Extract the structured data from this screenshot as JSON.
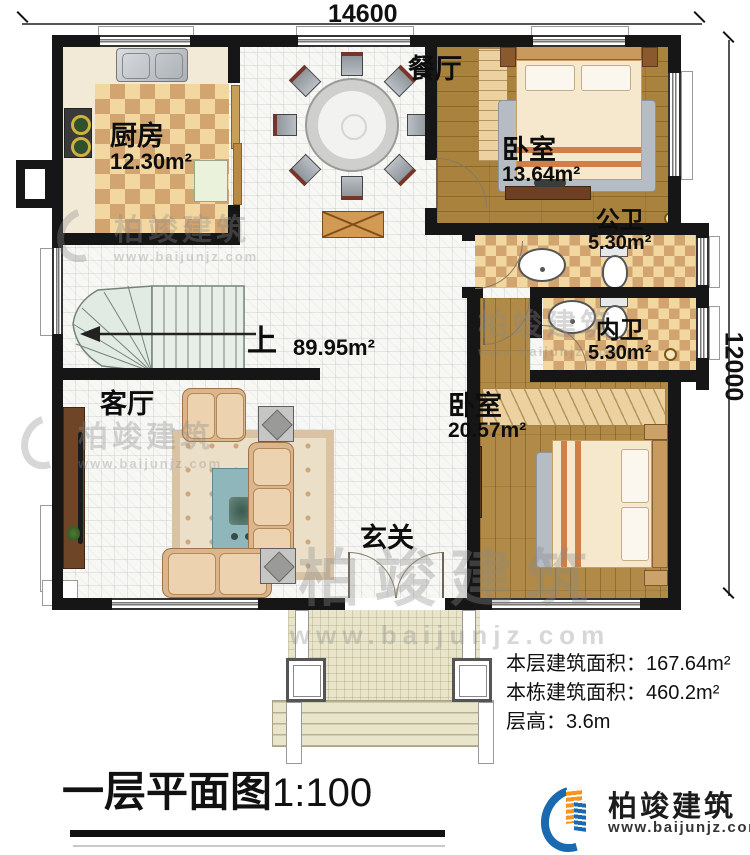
{
  "dimensions": {
    "top": "14600",
    "right": "12000"
  },
  "rooms": {
    "kitchen": {
      "name": "厨房",
      "area": "12.30m²"
    },
    "dining": {
      "name": "餐厅"
    },
    "bedroom1": {
      "name": "卧室",
      "area": "13.64m²"
    },
    "public_bath": {
      "name": "公卫",
      "area": "5.30m²"
    },
    "ensuite_bath": {
      "name": "内卫",
      "area": "5.30m²"
    },
    "bedroom2": {
      "name": "卧室",
      "area": "20.57m²"
    },
    "living": {
      "name": "客厅"
    },
    "foyer": {
      "name": "玄关"
    },
    "hall": {
      "area": "89.95m²"
    },
    "stairs": {
      "up_label": "上"
    }
  },
  "stats": {
    "floor_area_label": "本层建筑面积：",
    "floor_area_value": "167.64m²",
    "building_area_label": "本栋建筑面积：",
    "building_area_value": "460.2m²",
    "storey_height_label": "层高：",
    "storey_height_value": "3.6m"
  },
  "title": {
    "text": "一层平面图",
    "scale": "1:100"
  },
  "brand": {
    "company": "柏竣建筑",
    "website": "www.baijunjz.com"
  },
  "watermark": {
    "company": "柏竣建筑",
    "website": "www.baijunjz.com"
  },
  "colors": {
    "wall": "#161616",
    "wood": "#a9823e",
    "checker_light": "#f2d7a0",
    "checker_dark": "#d2a470",
    "brand_blue": "#1a6ab2",
    "brand_orange": "#f7941e"
  }
}
